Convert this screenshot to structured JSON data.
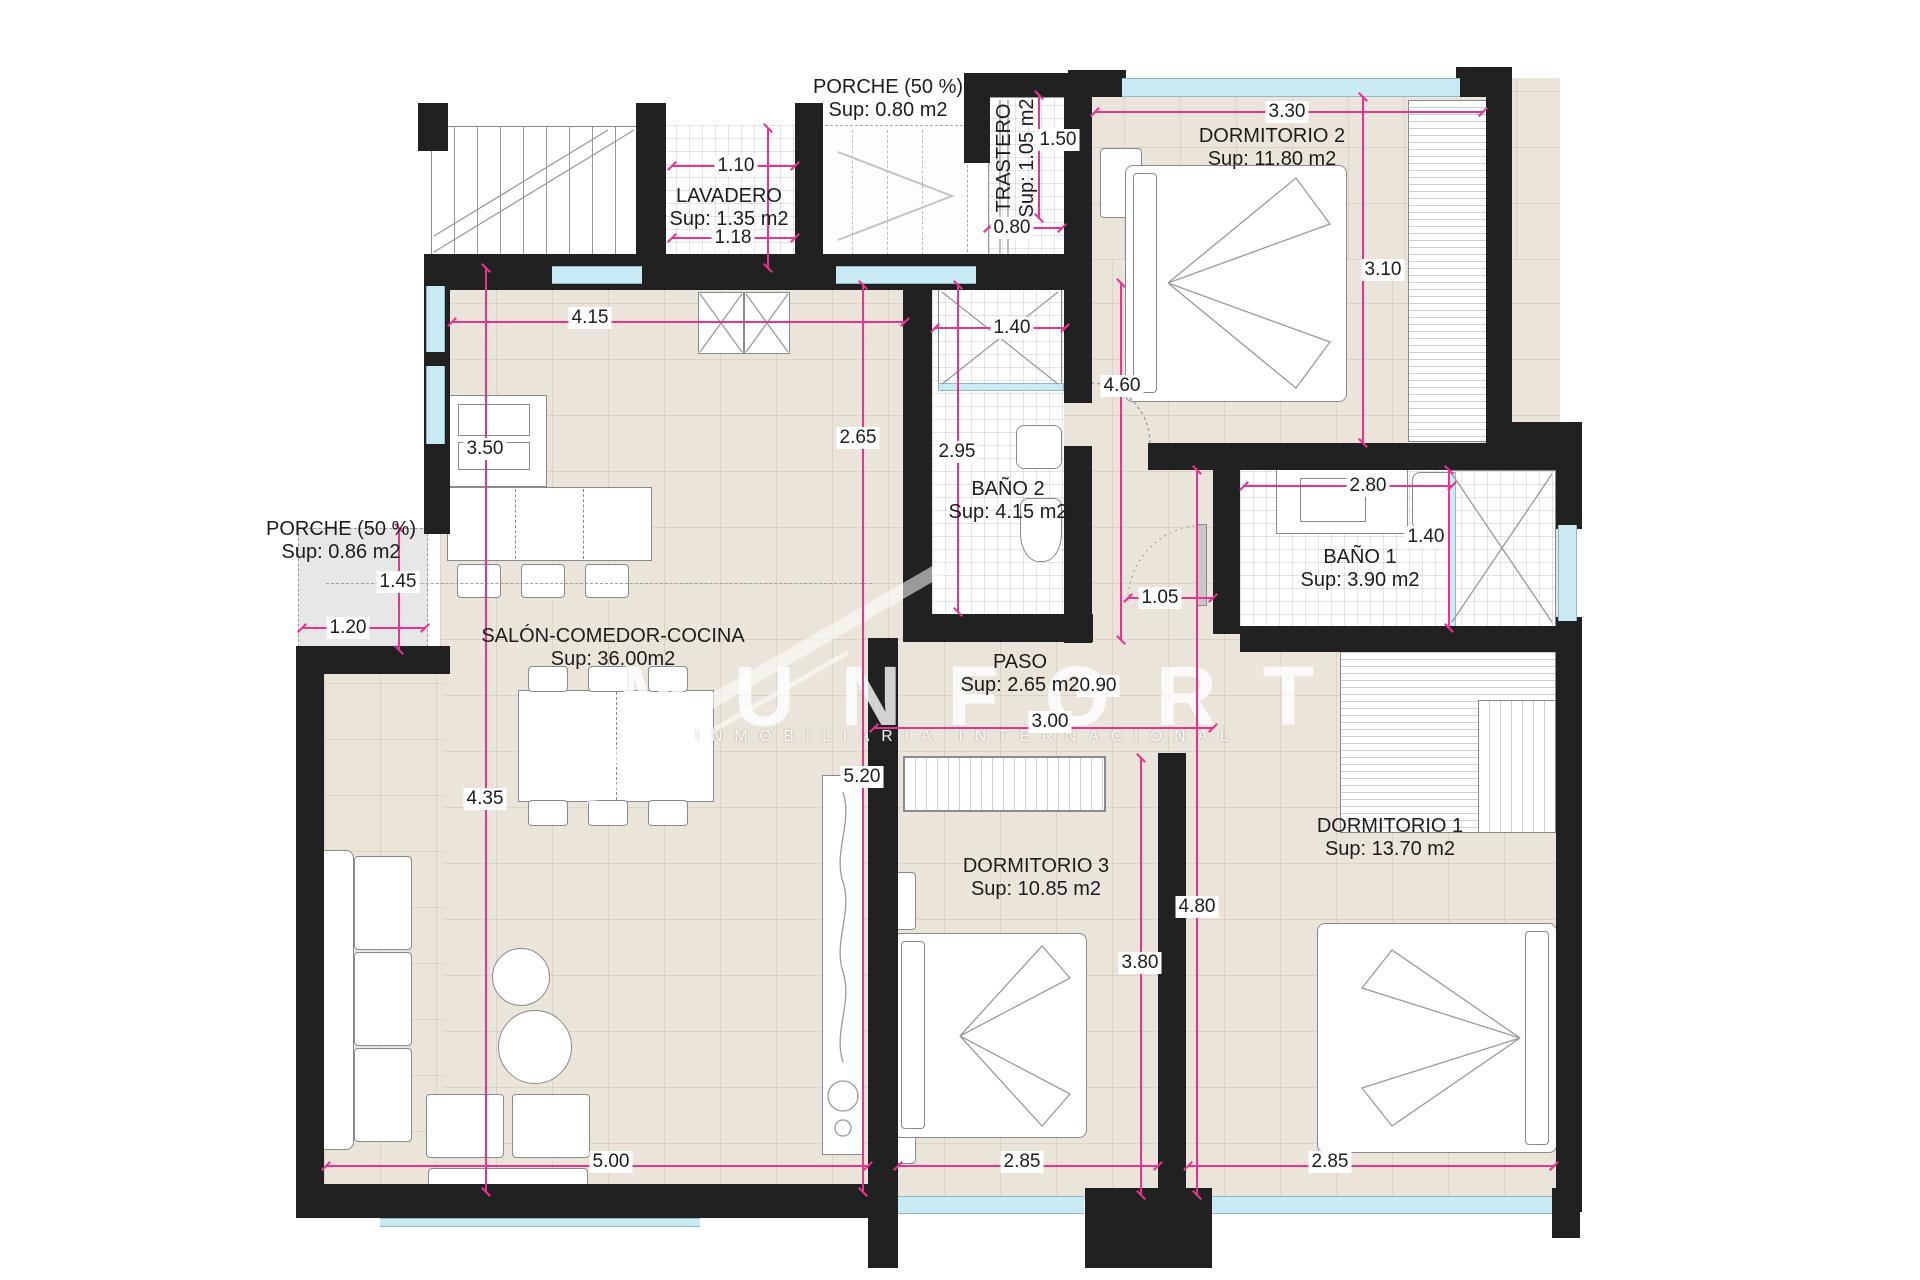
{
  "watermark": {
    "brand": "MUNFORT",
    "tagline": "INMOBILIARIA INTERNACIONAL"
  },
  "colors": {
    "dimension": "#e8338f",
    "wall": "#212121",
    "floor": "#eae4da",
    "window": "#c9eaf2"
  },
  "rooms": [
    {
      "id": "porche-top",
      "name": "PORCHE (50 %)",
      "area": "Sup: 0.80 m2"
    },
    {
      "id": "lavadero",
      "name": "LAVADERO",
      "area": "Sup: 1.35 m2"
    },
    {
      "id": "trastero",
      "name": "TRASTERO",
      "area": "Sup: 1.05 m2"
    },
    {
      "id": "dormitorio-2",
      "name": "DORMITORIO 2",
      "area": "Sup: 11.80 m2"
    },
    {
      "id": "bano-2",
      "name": "BAÑO 2",
      "area": "Sup: 4.15 m2"
    },
    {
      "id": "bano-1",
      "name": "BAÑO 1",
      "area": "Sup: 3.90 m2"
    },
    {
      "id": "porche-left",
      "name": "PORCHE (50 %)",
      "area": "Sup: 0.86 m2"
    },
    {
      "id": "salon",
      "name": "SALÓN-COMEDOR-COCINA",
      "area": "Sup: 36.00m2"
    },
    {
      "id": "paso",
      "name": "PASO",
      "area": "Sup: 2.65 m2"
    },
    {
      "id": "dormitorio-3",
      "name": "DORMITORIO 3",
      "area": "Sup: 10.85 m2"
    },
    {
      "id": "dormitorio-1",
      "name": "DORMITORIO 1",
      "area": "Sup: 13.70 m2"
    }
  ],
  "dimensions": {
    "lavadero_top": "1.10",
    "lavadero_bottom": "1.18",
    "trastero_height": "1.50",
    "trastero_width": "0.80",
    "dorm2_width": "3.30",
    "dorm2_height": "3.10",
    "dorm2_left": "4.60",
    "salon_top": "4.15",
    "salon_window": "3.50",
    "salon_mid": "2.65",
    "bano2_door": "1.40",
    "bano2_height": "2.95",
    "porche_left_height": "1.45",
    "porche_left_width": "1.20",
    "bano1_width": "2.80",
    "bano1_shower": "1.40",
    "paso_door": "1.05",
    "paso_door2": "0.90",
    "paso_width": "3.00",
    "hall_height": "5.20",
    "salon_lower": "4.35",
    "dorm1_height": "4.80",
    "dorm3_height": "3.80",
    "salon_bottom": "5.00",
    "dorm3_width": "2.85",
    "dorm1_width": "2.85"
  }
}
